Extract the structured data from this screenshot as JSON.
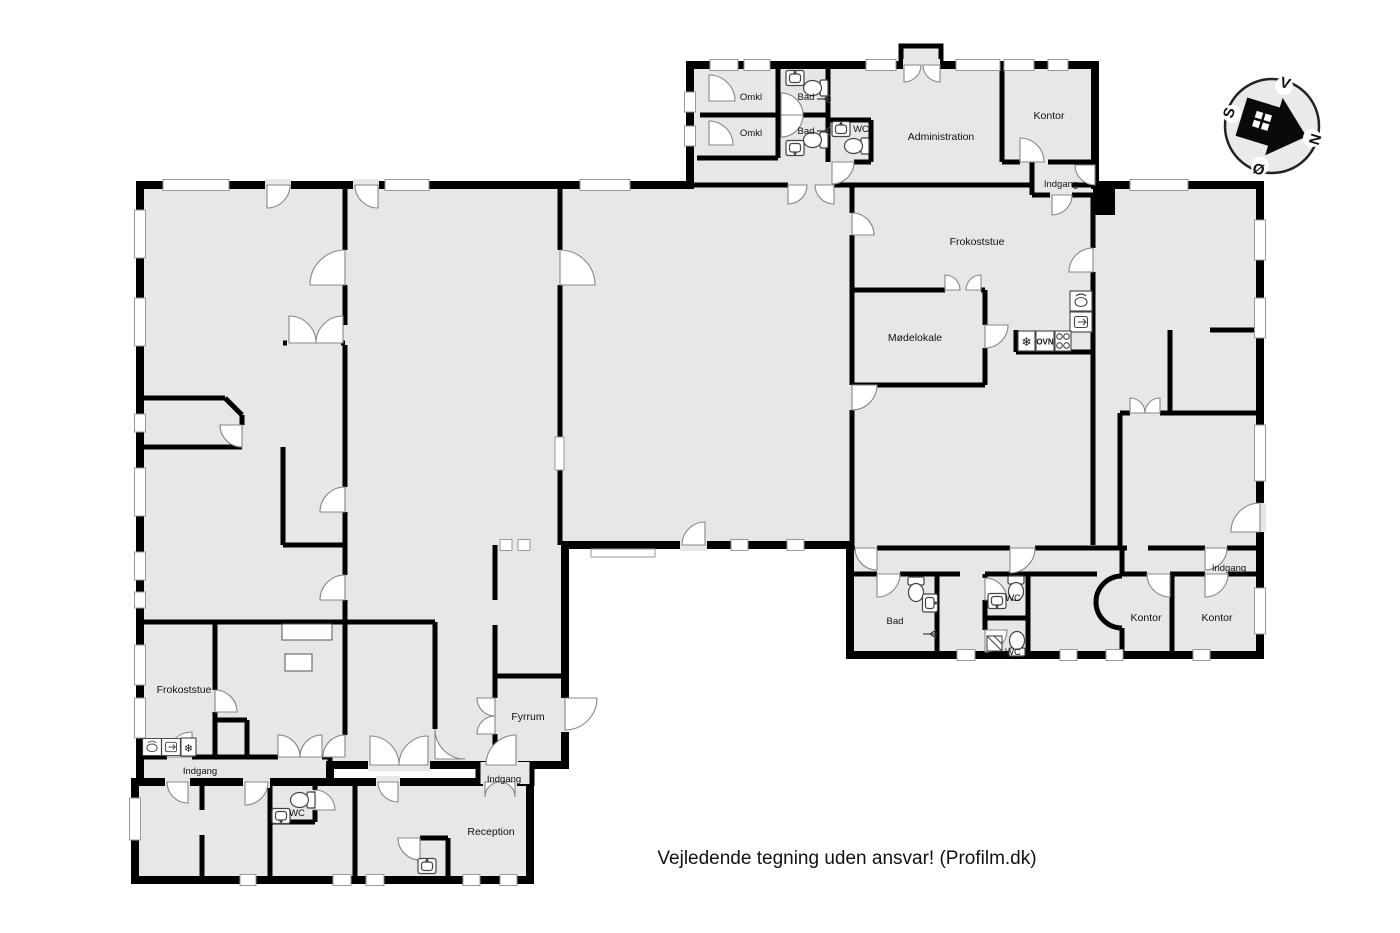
{
  "colors": {
    "background": "#ffffff",
    "floor": "#e7e7e7",
    "wall": "#000000",
    "door_arc_line": "#888888",
    "fixture_line": "#444444"
  },
  "rooms": {
    "omkl_a": "Omkl",
    "omkl_b": "Omkl",
    "bad_top_a": "Bad",
    "bad_top_b": "Bad",
    "wc_top": "WC",
    "administration": "Administration",
    "kontor_nw": "Kontor",
    "indgang_ne": "Indgang",
    "frokoststue_e": "Frokoststue",
    "modelokale": "Mødelokale",
    "bad_s": "Bad",
    "wc_s_upper": "WC",
    "wc_s_lower": "WC",
    "kontor_s_a": "Kontor",
    "kontor_s_b": "Kontor",
    "indgang_se": "Indgang",
    "frokoststue_w": "Frokoststue",
    "indgang_sw": "Indgang",
    "fyrrum": "Fyrrum",
    "indgang_s_mid": "Indgang",
    "wc_sw": "WC",
    "reception": "Reception"
  },
  "kitchen": {
    "oven": "OVN"
  },
  "icons": {
    "freezer_snowflake": "❄"
  },
  "compass": {
    "north": "N",
    "south": "S",
    "east": "Ø",
    "west": "V"
  },
  "footer": {
    "disclaimer": "Vejledende tegning uden ansvar! (Profilm.dk)"
  }
}
